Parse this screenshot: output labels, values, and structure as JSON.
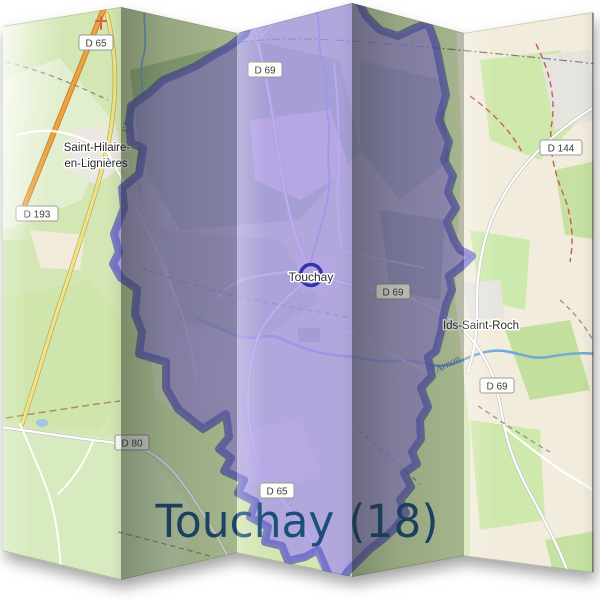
{
  "title": {
    "text": "Touchay (18)",
    "color": "#1b4e7c"
  },
  "map": {
    "shields": [
      {
        "id": "d65-nw",
        "text": "D 65"
      },
      {
        "id": "d69-n",
        "text": "D 69"
      },
      {
        "id": "d193-w",
        "text": "D 193"
      },
      {
        "id": "d144-ne",
        "text": "D 144"
      },
      {
        "id": "d69-e",
        "text": "D 69"
      },
      {
        "id": "d80-sw",
        "text": "D 80"
      },
      {
        "id": "d65-s",
        "text": "D 65"
      },
      {
        "id": "d69-se",
        "text": "D 69"
      }
    ],
    "places": [
      {
        "id": "saint-hilaire-line1",
        "text": "Saint-Hilaire-"
      },
      {
        "id": "saint-hilaire-line2",
        "text": "en-Lignières"
      },
      {
        "id": "touchay",
        "text": "Touchay"
      },
      {
        "id": "ids-saint-roch",
        "text": "Ids-Saint-Roch"
      }
    ],
    "rivers": [
      {
        "id": "arnon-west",
        "text": "l'Arnon"
      },
      {
        "id": "arnon-east",
        "text": "l'Arnon"
      }
    ],
    "colors": {
      "boundary": "#3434aa",
      "commune_fill": "rgba(165,145,235,0.5)",
      "land_green": "#d3e6b3",
      "land_cream": "#f2ecdc",
      "title": "#1b4e7c"
    }
  }
}
